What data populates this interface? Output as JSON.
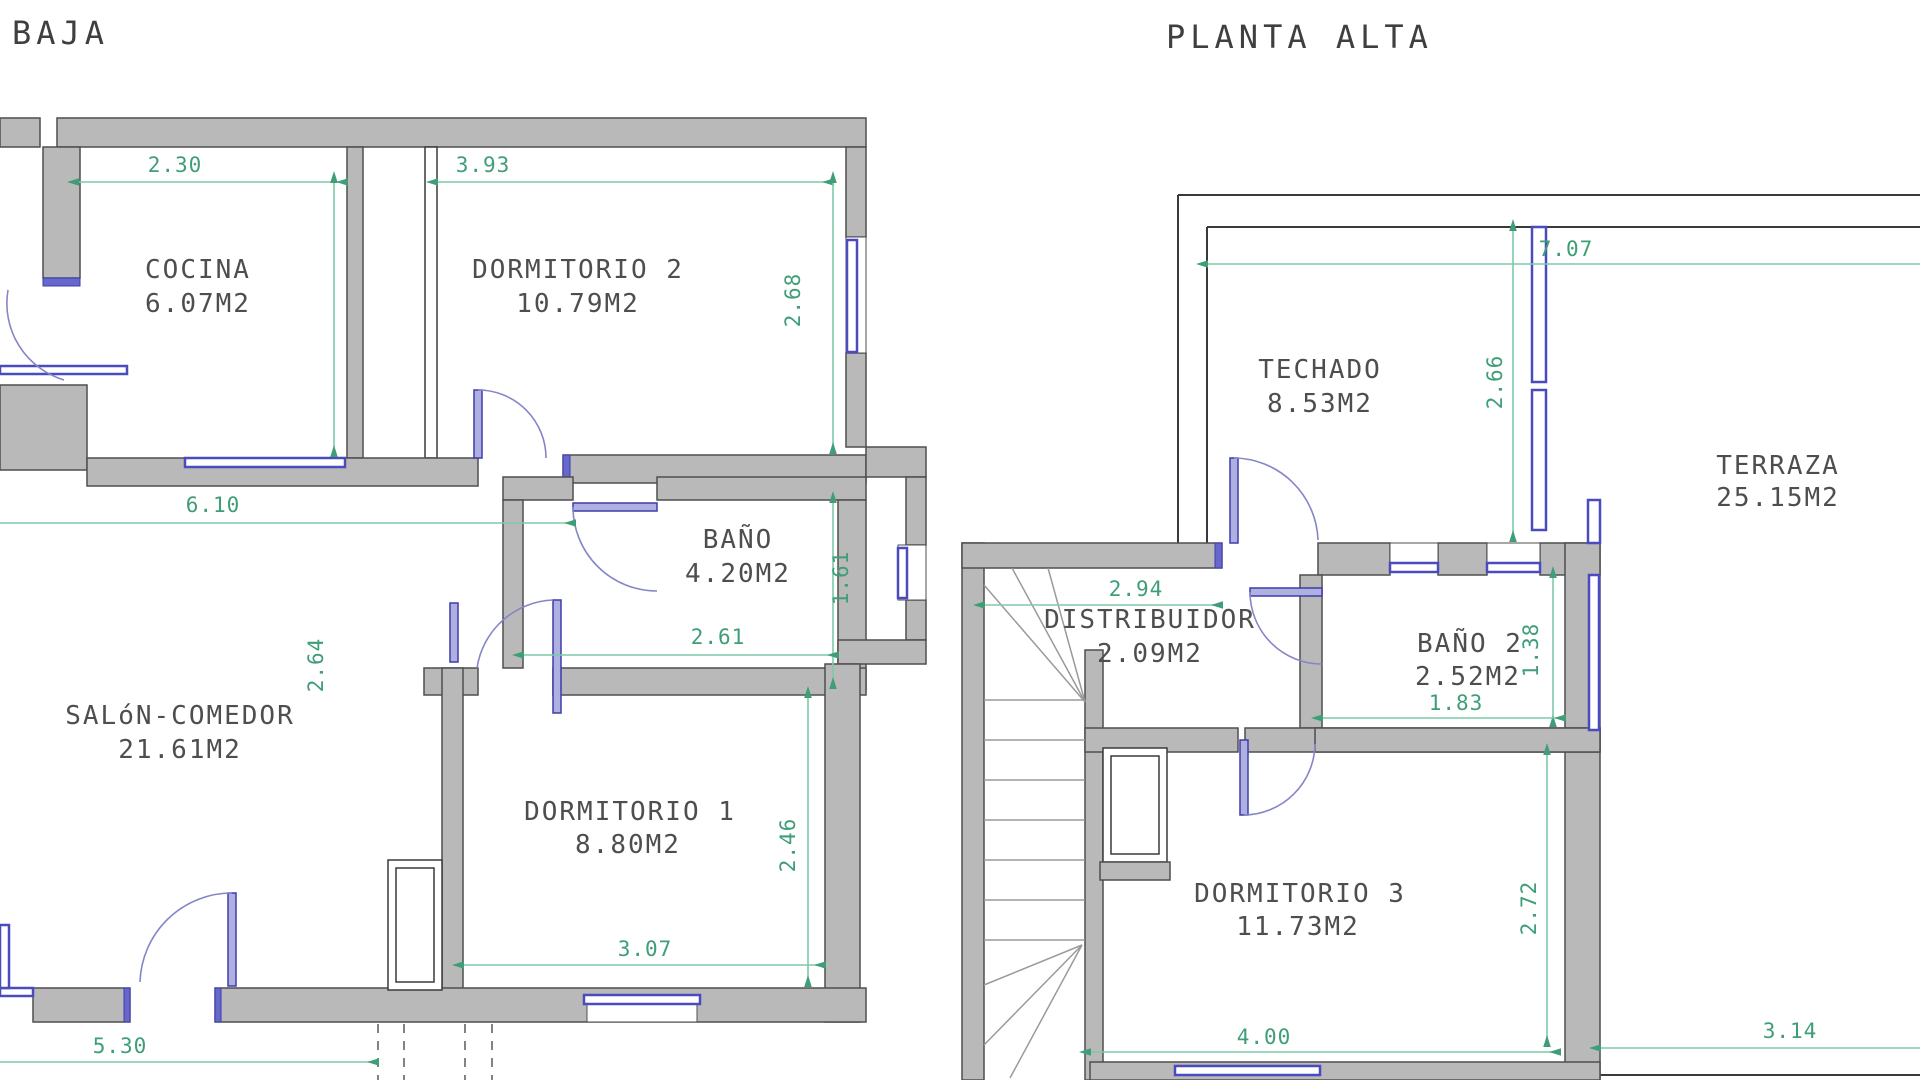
{
  "drawing": {
    "type": "architectural-floor-plan",
    "units": "meters",
    "background": "#ffffff"
  },
  "colors": {
    "wall_fill": "#b9b9b9",
    "wall_stroke": "#4f4f4f",
    "window_blue": "#4b4bc0",
    "door_blue": "#8585c8",
    "dimension_green": "#3f9d77",
    "dimension_line_green": "#7ec9a8",
    "label_gray": "#4e4e4e"
  },
  "plans": [
    {
      "title": "BAJA",
      "rooms": [
        {
          "name": "COCINA",
          "area": "6.07M2"
        },
        {
          "name": "DORMITORIO 2",
          "area": "10.79M2"
        },
        {
          "name": "BAÑO",
          "area": "4.20M2"
        },
        {
          "name": "SALóN-COMEDOR",
          "area": "21.61M2"
        },
        {
          "name": "DORMITORIO 1",
          "area": "8.80M2"
        }
      ],
      "dims": [
        {
          "value": "2.30",
          "orientation": "horizontal"
        },
        {
          "value": "3.93",
          "orientation": "horizontal"
        },
        {
          "value": "2.64",
          "orientation": "vertical"
        },
        {
          "value": "2.68",
          "orientation": "vertical"
        },
        {
          "value": "6.10",
          "orientation": "horizontal"
        },
        {
          "value": "1.61",
          "orientation": "vertical"
        },
        {
          "value": "2.61",
          "orientation": "horizontal"
        },
        {
          "value": "2.46",
          "orientation": "vertical"
        },
        {
          "value": "3.07",
          "orientation": "horizontal"
        },
        {
          "value": "5.30",
          "orientation": "horizontal"
        }
      ]
    },
    {
      "title": "PLANTA ALTA",
      "rooms": [
        {
          "name": "TECHADO",
          "area": "8.53M2"
        },
        {
          "name": "TERRAZA",
          "area": "25.15M2"
        },
        {
          "name": "DISTRIBUIDOR",
          "area": "2.09M2"
        },
        {
          "name": "BAÑO 2",
          "area": "2.52M2"
        },
        {
          "name": "DORMITORIO 3",
          "area": "11.73M2"
        }
      ],
      "dims": [
        {
          "value": "7.07",
          "orientation": "horizontal"
        },
        {
          "value": "2.66",
          "orientation": "vertical"
        },
        {
          "value": "2.94",
          "orientation": "horizontal"
        },
        {
          "value": "1.38",
          "orientation": "vertical"
        },
        {
          "value": "1.83",
          "orientation": "horizontal"
        },
        {
          "value": "2.72",
          "orientation": "vertical"
        },
        {
          "value": "4.00",
          "orientation": "horizontal"
        },
        {
          "value": "3.14",
          "orientation": "horizontal"
        }
      ]
    }
  ]
}
